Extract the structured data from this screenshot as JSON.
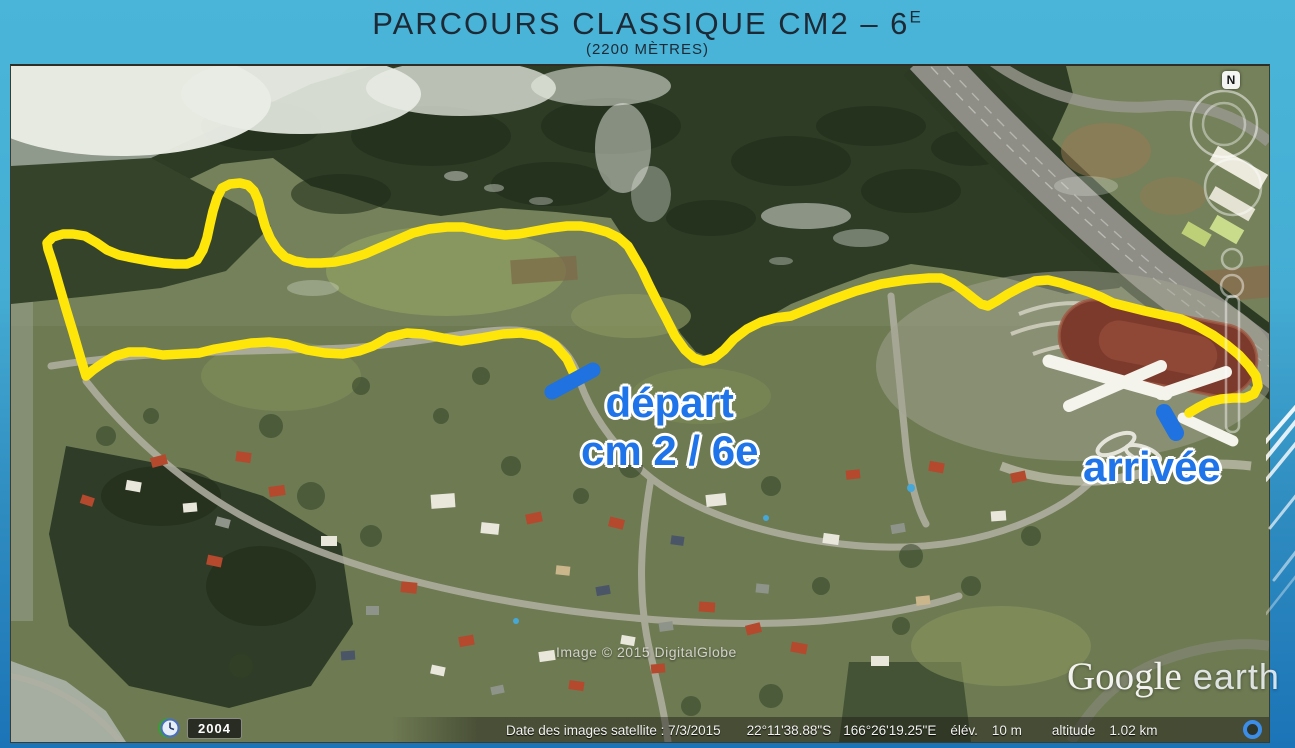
{
  "slide": {
    "title": "PARCOURS CLASSIQUE CM2 – 6",
    "title_sup": "E",
    "subtitle": "(2200 MÈTRES)"
  },
  "map": {
    "route_labels": {
      "depart_line1": "départ",
      "depart_line2": "cm 2 / 6e",
      "arrivee": "arrivée"
    },
    "compass": {
      "north_label": "N"
    },
    "historical_imagery": {
      "year": "2004"
    },
    "watermarks": {
      "imagery_credit": "Image © 2015 DigitalGlobe",
      "logo_primary": "Google",
      "logo_secondary": "earth"
    },
    "status_bar": {
      "date_label": "Date des images satellite : 7/3/2015",
      "latitude": "22°11'38.88\"S",
      "longitude": "166°26'19.25\"E",
      "elevation_label": "élév.",
      "elevation_value": "10 m",
      "altitude_label": "altitude",
      "altitude_value": "1.02 km"
    },
    "colors": {
      "route_yellow": "#ffe60a",
      "marker_blue": "#1f72e0",
      "label_blue": "#1e74e8",
      "slide_bg_top": "#4ab5d9",
      "slide_bg_bottom": "#1b74b7"
    }
  }
}
